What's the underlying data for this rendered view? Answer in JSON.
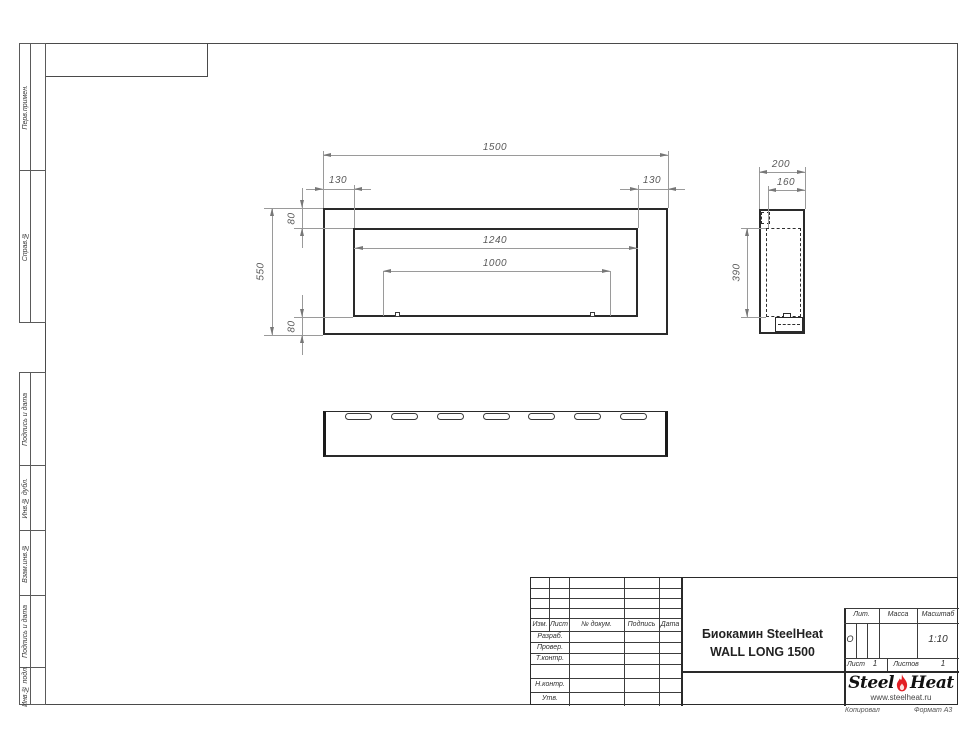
{
  "sheet": {
    "copied_label": "Копировал",
    "format_label": "Формат А3"
  },
  "sidebar": {
    "labels": [
      {
        "text": "Перв.примен."
      },
      {
        "text": "Справ.№"
      },
      {
        "text": "Подпись и дата"
      },
      {
        "text": "Инв.№ дубл."
      },
      {
        "text": "Взам.инв.№"
      },
      {
        "text": "Подпись и дата"
      },
      {
        "text": "Инв.№ подл."
      }
    ]
  },
  "drawing": {
    "front_view": {
      "overall_width": "1500",
      "overall_height": "550",
      "left_margin": "130",
      "right_margin": "130",
      "top_margin": "80",
      "bottom_margin": "80",
      "opening_width": "1240",
      "burner_length": "1000"
    },
    "side_view": {
      "depth": "200",
      "inner_depth": "160",
      "opening_height": "390"
    },
    "bottom_view": {
      "slot_count": 7
    }
  },
  "title_block": {
    "columns": {
      "izm": "Изм.",
      "list": "Лист",
      "doc": "№ докум.",
      "sign": "Подпись",
      "date": "Дата"
    },
    "rows": {
      "developed": "Разраб.",
      "checked": "Провер.",
      "tcontrol": "Т.контр.",
      "ncontrol": "Н.контр.",
      "approved": "Утв."
    },
    "title_line1": "Биокамин SteelHeat",
    "title_line2": "WALL LONG 1500",
    "lit_label": "Лит.",
    "lit_value": "О",
    "mass_label": "Масса",
    "scale_label": "Масштаб",
    "scale_value": "1:10",
    "sheet_label": "Лист",
    "sheet_value": "1",
    "sheets_label": "Листов",
    "sheets_value": "1",
    "logo": {
      "word1": "Steel",
      "word2": "Heat",
      "website": "www.steelheat.ru",
      "flame_color": "#e31e24"
    }
  }
}
